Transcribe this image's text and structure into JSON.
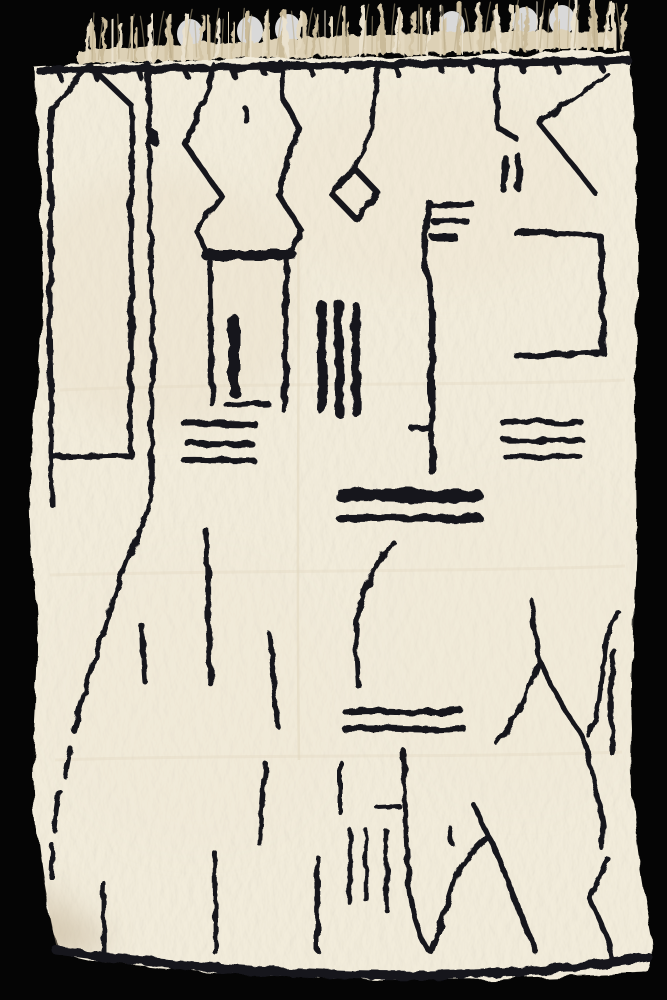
{
  "image": {
    "alt_text": "Cream white shaggy Beni Ourain style wool rug with black abstract freehand line motifs, tasseled fringe along the top edge, photographed on a black background",
    "background_color": "#050505",
    "rug_color": "#f2ecdb",
    "rug_edge_shade": "#e2d7bf",
    "line_color": "#16161e",
    "fringe_band_color": "#ddd1b6",
    "fringe_strand_colors": [
      "#e3d8bf",
      "#d3c5a6",
      "#cabb9a",
      "#eae1cd"
    ],
    "fringe_highlight_color": "#ffffff",
    "shading_colors": [
      "#e9dcc2",
      "#ece0c8",
      "#efe6d2",
      "#c0b094"
    ]
  },
  "rug": {
    "outline": "M34,67 C120,62 300,58 450,55 C520,53 580,53 630,52 C633,100 638,160 636,220 C640,300 632,400 636,480 C639,560 629,650 632,730 C628,800 640,870 652,935 C655,950 653,965 648,973 C560,977 460,981 360,978 C260,976 150,968 100,961 C80,958 62,953 57,948 C45,900 38,850 34,800 C30,740 40,680 37,620 C33,560 27,520 30,470 C34,400 46,330 44,270 C42,200 36,130 34,67 Z",
    "crease_vertical": "M298,220 C300,380 296,560 299,760",
    "creases_horizontal": "M60,390 C250,382 480,386 625,380 M50,575 C250,570 470,572 625,566 M55,760 C250,754 470,758 622,752"
  },
  "fringe": {
    "x_start": 84,
    "x_end": 622,
    "band": "M78,64 C200,60 420,53 612,47 L616,32 C450,28 250,40 78,50 Z",
    "count": 62,
    "highlights": [
      {
        "x": 190,
        "y": 34
      },
      {
        "x": 250,
        "y": 31
      },
      {
        "x": 288,
        "y": 29
      },
      {
        "x": 452,
        "y": 26
      },
      {
        "x": 525,
        "y": 22
      },
      {
        "x": 562,
        "y": 20
      }
    ]
  },
  "motifs": [
    {
      "name": "top-border",
      "d": "M40,71 C150,68 300,65 450,63 C520,62 580,62 628,60",
      "w": 8
    },
    {
      "name": "top-border-ticks",
      "d": "M60,73 l2,7 M95,71 l2,8 M140,70 l3,10 M185,69 l2,7 M232,68 l3,9 M262,67 l2,6 M310,66 l3,9 M345,65 l2,7 M395,65 l3,10 M440,64 l2,7 M470,64 l3,8 M520,63 l2,7 M556,63 l3,9 M600,62 l2,7",
      "w": 5.5
    },
    {
      "name": "house-outline",
      "d": "M90,66 L51,107 C48,160 53,230 50,290 C48,350 53,410 51,457 L131,456 C128,400 134,330 131,260 C129,200 134,150 132,106 Z",
      "w": 5.5
    },
    {
      "name": "house-left-tail",
      "d": "M51,460 C51,475 52,490 52,505",
      "w": 5
    },
    {
      "name": "wavy-line-main",
      "d": "M148,64 C151,120 148,200 152,280 C155,360 149,440 152,497 C143,520 128,560 113,600 C100,640 85,690 74,731 M70,748 C68,758 66,766 65,776 M60,792 C58,805 56,818 55,831 M53,846 C52,856 51,866 51,877",
      "w": 5
    },
    {
      "name": "wavy-line-dot",
      "d": "M153,132 L155,143",
      "w": 7
    },
    {
      "name": "mark-dot",
      "d": "M245,108 C247,113 246,117 247,122",
      "w": 5.5
    },
    {
      "name": "hourglass-left",
      "d": "M212,64 L210,88 L184,143 L222,197 L196,231 L206,250",
      "w": 5.5
    },
    {
      "name": "hourglass-right",
      "d": "M281,63 L283,99 L299,128 L278,194 L301,230 L291,250",
      "w": 5.5
    },
    {
      "name": "hourglass-bar",
      "d": "M206,255 L292,255",
      "w": 10
    },
    {
      "name": "column-left",
      "d": "M210,261 C208,300 213,360 212,404",
      "w": 5.5
    },
    {
      "name": "column-right",
      "d": "M287,261 C284,305 287,370 284,410",
      "w": 5.5
    },
    {
      "name": "column-inner-bar",
      "d": "M234,320 L234,392",
      "w": 11
    },
    {
      "name": "column-dash",
      "d": "M228,406 L268,404",
      "w": 6
    },
    {
      "name": "diamond-line",
      "d": "M381,63 C372,88 375,120 368,143 L354,167",
      "w": 5
    },
    {
      "name": "diamond",
      "d": "M354,168 L378,193 L355,218 L331,193 Z",
      "w": 6
    },
    {
      "name": "right-line-hook",
      "d": "M497,63 C496,90 497,110 497,127 L517,139",
      "w": 5.5
    },
    {
      "name": "k-diagonal",
      "d": "M607,74 C584,90 560,107 539,123 C557,146 577,169 594,192",
      "w": 5
    },
    {
      "name": "pause-bar-left",
      "d": "M505,158 L504,190",
      "w": 6.5
    },
    {
      "name": "pause-bar-right",
      "d": "M519,157 L518,188",
      "w": 6.5
    },
    {
      "name": "bracket",
      "d": "M516,233 C545,231 575,234 601,237 L603,352 C575,354 545,355 517,356",
      "w": 6
    },
    {
      "name": "e-spine",
      "d": "M430,203 C426,230 421,255 427,272 C431,284 431,300 432,312",
      "w": 6
    },
    {
      "name": "e-arm-top",
      "d": "M432,206 L472,204",
      "w": 5.5
    },
    {
      "name": "e-arm-mid",
      "d": "M433,221 L467,221",
      "w": 5.5
    },
    {
      "name": "e-arm-low",
      "d": "M433,237 L455,237",
      "w": 7
    },
    {
      "name": "center-line",
      "d": "M432,310 C434,340 430,380 432,405 C433,420 430,430 431,447 C432,457 433,464 433,470",
      "w": 6
    },
    {
      "name": "center-line-end",
      "d": "M432,450 L433,471",
      "w": 9
    },
    {
      "name": "center-line-tick",
      "d": "M412,429 L429,428",
      "w": 5
    },
    {
      "name": "bars-trio-1",
      "d": "M322,305 C321,340 323,380 322,410",
      "w": 9
    },
    {
      "name": "bars-trio-2",
      "d": "M339,304 C338,340 341,380 340,414",
      "w": 9
    },
    {
      "name": "bars-trio-3",
      "d": "M356,307 C355,340 357,380 356,412",
      "w": 9
    },
    {
      "name": "left-dashes-1",
      "d": "M184,423 C208,421 232,425 254,423",
      "w": 6.5
    },
    {
      "name": "left-dashes-2",
      "d": "M188,444 C210,443 232,446 252,444",
      "w": 6
    },
    {
      "name": "left-dashes-3",
      "d": "M184,460 C207,459 231,462 253,460",
      "w": 6
    },
    {
      "name": "right-dashes-1",
      "d": "M502,422 C529,420 556,424 582,423",
      "w": 5.5
    },
    {
      "name": "right-dashes-2",
      "d": "M504,440 C530,439 556,442 581,440",
      "w": 5.5
    },
    {
      "name": "right-dashes-3",
      "d": "M506,457 C531,456 556,459 580,457",
      "w": 5.5
    },
    {
      "name": "thick-bar",
      "d": "M341,495 C385,493 435,498 477,496",
      "w": 13
    },
    {
      "name": "thick-bar-2",
      "d": "M340,518 C386,517 436,520 479,518",
      "w": 8
    },
    {
      "name": "paren-curve",
      "d": "M393,542 C372,570 359,596 357,625 C355,650 357,668 358,686",
      "w": 5
    },
    {
      "name": "wavy-dash-1",
      "d": "M346,712 C384,708 424,715 461,711",
      "w": 6.5
    },
    {
      "name": "wavy-dash-2",
      "d": "M345,729 C383,726 425,732 463,728",
      "w": 6.5
    },
    {
      "name": "short-line-a",
      "d": "M142,625 C144,645 143,662 145,682",
      "w": 5
    },
    {
      "name": "mid-line-b",
      "d": "M206,530 C210,565 207,610 210,645 C211,662 211,672 211,684",
      "w": 5.5
    },
    {
      "name": "diag-line-c",
      "d": "M269,634 C272,662 274,694 279,727",
      "w": 5
    },
    {
      "name": "fork-line",
      "d": "M531,600 C534,622 536,640 539,660 C534,675 528,690 522,702 C514,720 505,732 497,743 M539,660 C550,685 564,710 580,732 C583,739 586,745 587,751",
      "w": 5
    },
    {
      "name": "right-line-a",
      "d": "M618,612 C611,626 606,641 605,656 C602,673 601,689 599,704 C597,716 593,727 589,736",
      "w": 5
    },
    {
      "name": "right-line-b",
      "d": "M614,651 C612,672 610,691 611,711 C612,726 613,741 613,754",
      "w": 5
    },
    {
      "name": "right-line-c",
      "d": "M587,752 C594,780 600,804 603,827 C603,834 602,841 602,848",
      "w": 5
    },
    {
      "name": "right-line-d",
      "d": "M607,858 C600,877 594,889 590,898 C596,914 604,928 608,941 C610,947 611,952 612,958",
      "w": 5
    },
    {
      "name": "bottom-border",
      "d": "M57,951 C150,963 250,972 350,975 C450,978 565,971 648,957",
      "w": 9
    },
    {
      "name": "bottom-tick-1",
      "d": "M104,884 C103,908 104,932 104,953",
      "w": 5
    },
    {
      "name": "bottom-tick-2",
      "d": "M215,853 C214,885 216,925 216,953",
      "w": 5
    },
    {
      "name": "bottom-tick-3",
      "d": "M266,764 C263,790 261,817 259,843",
      "w": 5
    },
    {
      "name": "bottom-tick-4",
      "d": "M318,858 C317,890 317,922 317,950",
      "w": 5
    },
    {
      "name": "comb-line-0",
      "d": "M341,763 C341,780 341,797 341,813",
      "w": 5
    },
    {
      "name": "comb-tick",
      "d": "M378,808 L400,807",
      "w": 5
    },
    {
      "name": "comb-line-1",
      "d": "M350,830 L350,903",
      "w": 4.5
    },
    {
      "name": "comb-line-2",
      "d": "M366,830 L366,900",
      "w": 4.5
    },
    {
      "name": "comb-line-3",
      "d": "M386,830 L386,910",
      "w": 4.5
    },
    {
      "name": "lambda-left-line",
      "d": "M403,750 C405,795 407,850 409,882 C410,908 418,933 429,951",
      "w": 5
    },
    {
      "name": "lambda",
      "d": "M431,952 C440,929 448,901 456,876 C465,858 478,845 488,836 C495,846 501,863 508,883 C515,901 526,927 536,952",
      "w": 5.5
    },
    {
      "name": "lambda-hook",
      "d": "M488,836 C483,824 477,812 473,804",
      "w": 5
    },
    {
      "name": "lambda-stub",
      "d": "M449,827 L452,843",
      "w": 5
    }
  ],
  "shading": {
    "spots": [
      {
        "x": 160,
        "y": 300,
        "rx": 140,
        "ry": 130,
        "c": 0,
        "o": 0.3
      },
      {
        "x": 430,
        "y": 190,
        "rx": 160,
        "ry": 100,
        "c": 1,
        "o": 0.22
      },
      {
        "x": 520,
        "y": 640,
        "rx": 150,
        "ry": 170,
        "c": 2,
        "o": 0.25
      },
      {
        "x": 200,
        "y": 700,
        "rx": 160,
        "ry": 150,
        "c": 2,
        "o": 0.2
      },
      {
        "x": 60,
        "y": 938,
        "rx": 48,
        "ry": 20,
        "c": 3,
        "o": 0.45
      },
      {
        "x": 46,
        "y": 915,
        "rx": 30,
        "ry": 28,
        "c": 3,
        "o": 0.3
      }
    ]
  }
}
